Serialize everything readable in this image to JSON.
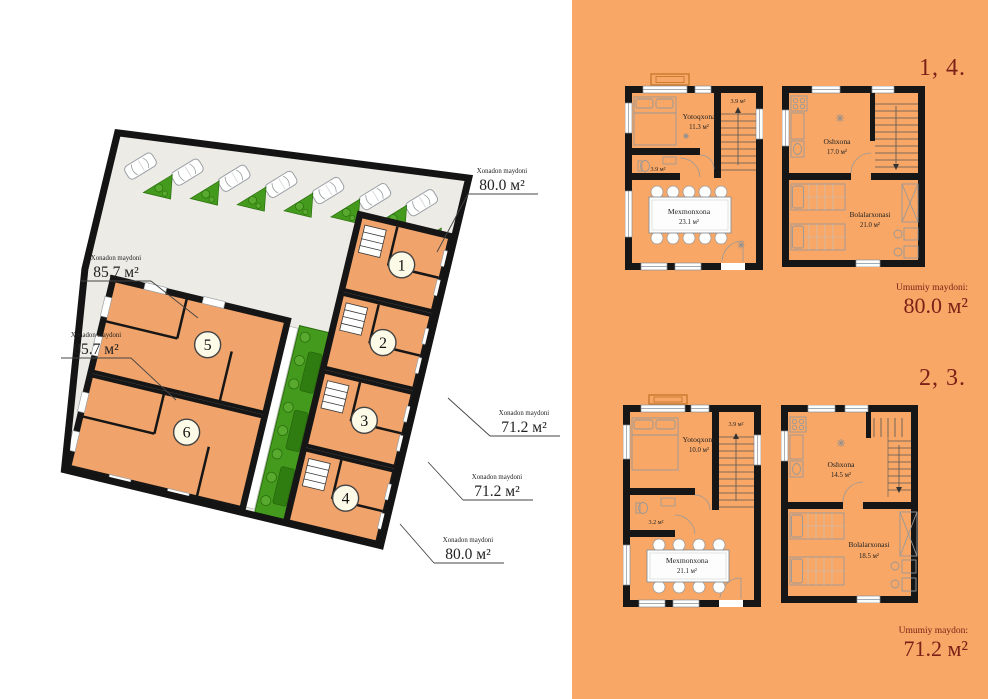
{
  "colors": {
    "panel_orange": "#f8a766",
    "accent_maroon": "#7b2218",
    "unit_orange": "#f0a36a",
    "landscape_green": "#449a1c",
    "wall_black": "#161616"
  },
  "site_plan": {
    "unit_markers": [
      "1",
      "2",
      "3",
      "4",
      "5",
      "6"
    ],
    "area_labels": [
      {
        "title": "Xonadon maydoni",
        "value": "80.0 м²"
      },
      {
        "title": "Xonadon maydoni",
        "value": "71.2 м²"
      },
      {
        "title": "Xonadon maydoni",
        "value": "71.2 м²"
      },
      {
        "title": "Xonadon maydoni",
        "value": "80.0 м²"
      },
      {
        "title": "Xonadon maydoni",
        "value": "85.7 м²"
      },
      {
        "title": "Xonadon maydoni",
        "value": "85.7 м²"
      }
    ]
  },
  "floor_plans": {
    "group_80": {
      "units_label": "1, 4.",
      "total_title": "Umumiy maydoni:",
      "total_value": "80.0 м²",
      "floor1": {
        "bedroom_name": "Yotoqxona",
        "bedroom_area": "11.3 м²",
        "stair_area": "3.9 м²",
        "bath_area": "3.9 м²",
        "living_name": "Mexmonxona",
        "living_area": "23.1 м²"
      },
      "floor2": {
        "kitchen_name": "Oshxona",
        "kitchen_area": "17.0 м²",
        "kids_name": "Bolalarxonasi",
        "kids_area": "21.0 м²"
      }
    },
    "group_71": {
      "units_label": "2, 3.",
      "total_title": "Umumiy maydon:",
      "total_value": "71.2 м²",
      "floor1": {
        "bedroom_name": "Yotoqxona",
        "bedroom_area": "10.0 м²",
        "stair_area": "3.9 м²",
        "bath_area": "3.2 м²",
        "living_name": "Mexmonxona",
        "living_area": "21.1 м²"
      },
      "floor2": {
        "kitchen_name": "Oshxona",
        "kitchen_area": "14.5 м²",
        "kids_name": "Bolalarxonasi",
        "kids_area": "18.5 м²"
      }
    }
  }
}
